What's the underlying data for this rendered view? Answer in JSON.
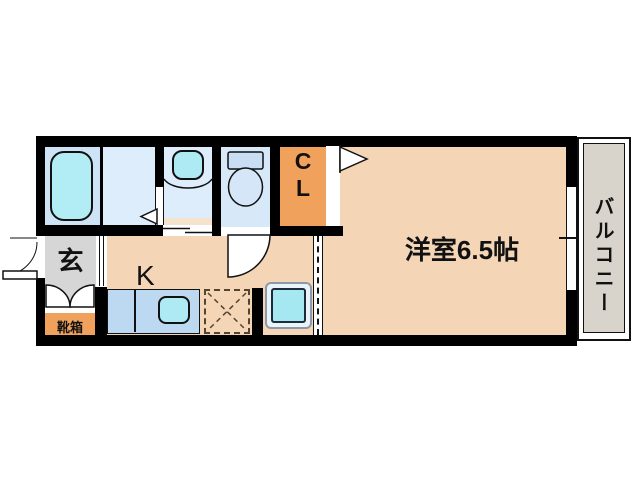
{
  "plan": {
    "type": "apartment-floorplan",
    "rooms": {
      "main_room": "洋室6.5帖",
      "balcony": "バルコニー",
      "entrance": "玄",
      "kitchen": "K",
      "closet_line1": "C",
      "closet_line2": "L",
      "shoe_box": "靴箱"
    },
    "fixtures": [
      "bathtub-icon",
      "washbasin-icon",
      "toilet-icon",
      "kitchen-sink-icon",
      "refrigerator-space-icon",
      "washing-machine-icon",
      "door-swing-icon",
      "sliding-door-icon",
      "window-icon",
      "entrance-door-icon",
      "double-door-icon",
      "closet-door-flag-icon"
    ],
    "colors": {
      "wall": "#000000",
      "flooring_peach": "#f4d5b5",
      "closet_orange": "#f0a15b",
      "bath_blue": "#cfe3f6",
      "washroom_blue": "#ddedfb",
      "toilet_blue": "#d7e8f8",
      "fixture_cyan": "#aeeaf4",
      "counter_blue": "#bdd8f1",
      "genkan_gray": "#d6d6d6",
      "balcony_gray": "#d9d4cb"
    }
  }
}
